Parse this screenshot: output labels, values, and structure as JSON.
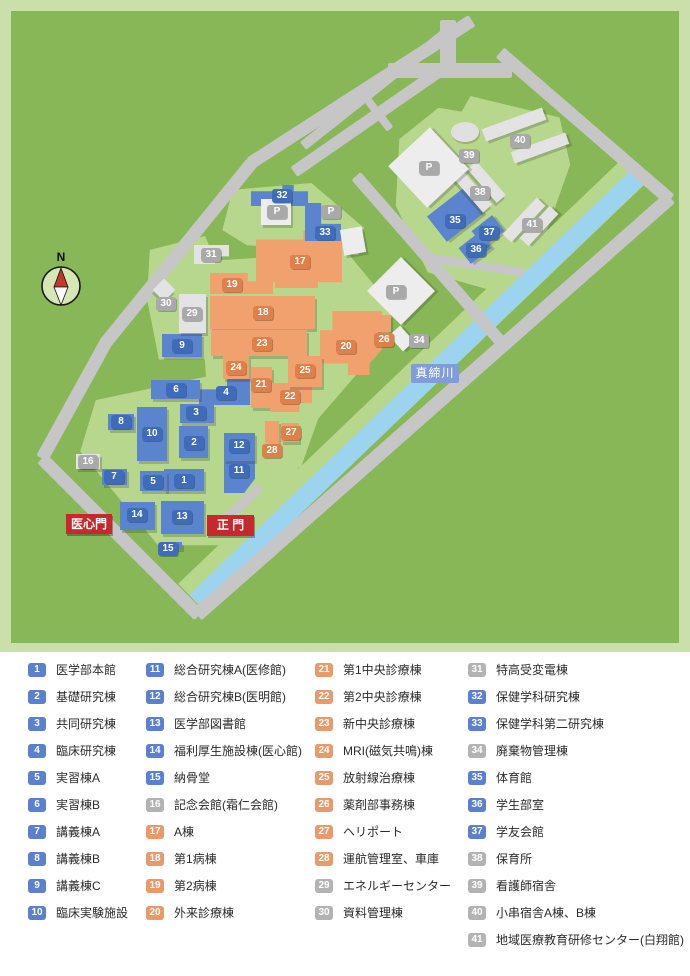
{
  "map": {
    "compass_label": "N",
    "river_label": "真締川",
    "gate_labels": [
      "医心門",
      "正 門"
    ],
    "parking_label": "P",
    "colors": {
      "badge": {
        "blue": "#5b80cf",
        "orange": "#e9996a",
        "gray": "#b3b3b3"
      },
      "chip": {
        "blue": "#3e6cb8",
        "orange": "#df7f4a",
        "gray": "#a9a9a9"
      },
      "building": {
        "blue": "#5a84cd",
        "orange": "#f0a16e",
        "gray": "#e3e3e3"
      }
    }
  },
  "legend": {
    "items": [
      {
        "n": "1",
        "c": "blue",
        "label": "医学部本館"
      },
      {
        "n": "2",
        "c": "blue",
        "label": "基礎研究棟"
      },
      {
        "n": "3",
        "c": "blue",
        "label": "共同研究棟"
      },
      {
        "n": "4",
        "c": "blue",
        "label": "臨床研究棟"
      },
      {
        "n": "5",
        "c": "blue",
        "label": "実習棟A"
      },
      {
        "n": "6",
        "c": "blue",
        "label": "実習棟B"
      },
      {
        "n": "7",
        "c": "blue",
        "label": "講義棟A"
      },
      {
        "n": "8",
        "c": "blue",
        "label": "講義棟B"
      },
      {
        "n": "9",
        "c": "blue",
        "label": "講義棟C"
      },
      {
        "n": "10",
        "c": "blue",
        "label": "臨床実験施設"
      },
      {
        "n": "11",
        "c": "blue",
        "label": "総合研究棟A(医修館)"
      },
      {
        "n": "12",
        "c": "blue",
        "label": "総合研究棟B(医明館)"
      },
      {
        "n": "13",
        "c": "blue",
        "label": "医学部図書館"
      },
      {
        "n": "14",
        "c": "blue",
        "label": "福利厚生施設棟(医心館)"
      },
      {
        "n": "15",
        "c": "blue",
        "label": "納骨堂"
      },
      {
        "n": "16",
        "c": "gray",
        "label": "記念会館(霜仁会館)"
      },
      {
        "n": "17",
        "c": "orange",
        "label": "A棟"
      },
      {
        "n": "18",
        "c": "orange",
        "label": "第1病棟"
      },
      {
        "n": "19",
        "c": "orange",
        "label": "第2病棟"
      },
      {
        "n": "20",
        "c": "orange",
        "label": "外来診療棟"
      },
      {
        "n": "21",
        "c": "orange",
        "label": "第1中央診療棟"
      },
      {
        "n": "22",
        "c": "orange",
        "label": "第2中央診療棟"
      },
      {
        "n": "23",
        "c": "orange",
        "label": "新中央診療棟"
      },
      {
        "n": "24",
        "c": "orange",
        "label": "MRI(磁気共鳴)棟"
      },
      {
        "n": "25",
        "c": "orange",
        "label": "放射線治療棟"
      },
      {
        "n": "26",
        "c": "orange",
        "label": "薬剤部事務棟"
      },
      {
        "n": "27",
        "c": "orange",
        "label": "ヘリポート"
      },
      {
        "n": "28",
        "c": "orange",
        "label": "運航管理室、車庫"
      },
      {
        "n": "29",
        "c": "gray",
        "label": "エネルギーセンター"
      },
      {
        "n": "30",
        "c": "gray",
        "label": "資料管理棟"
      },
      {
        "n": "31",
        "c": "gray",
        "label": "特高受変電棟"
      },
      {
        "n": "32",
        "c": "blue",
        "label": "保健学科研究棟"
      },
      {
        "n": "33",
        "c": "blue",
        "label": "保健学科第二研究棟"
      },
      {
        "n": "34",
        "c": "gray",
        "label": "廃棄物管理棟"
      },
      {
        "n": "35",
        "c": "blue",
        "label": "体育館"
      },
      {
        "n": "36",
        "c": "blue",
        "label": "学生部室"
      },
      {
        "n": "37",
        "c": "blue",
        "label": "学友会館"
      },
      {
        "n": "38",
        "c": "gray",
        "label": "保育所"
      },
      {
        "n": "39",
        "c": "gray",
        "label": "看護師宿舎"
      },
      {
        "n": "40",
        "c": "gray",
        "label": "小串宿舎A棟、B棟"
      },
      {
        "n": "41",
        "c": "gray",
        "label": "地域医療教育研修センター(白翔館)"
      }
    ]
  }
}
